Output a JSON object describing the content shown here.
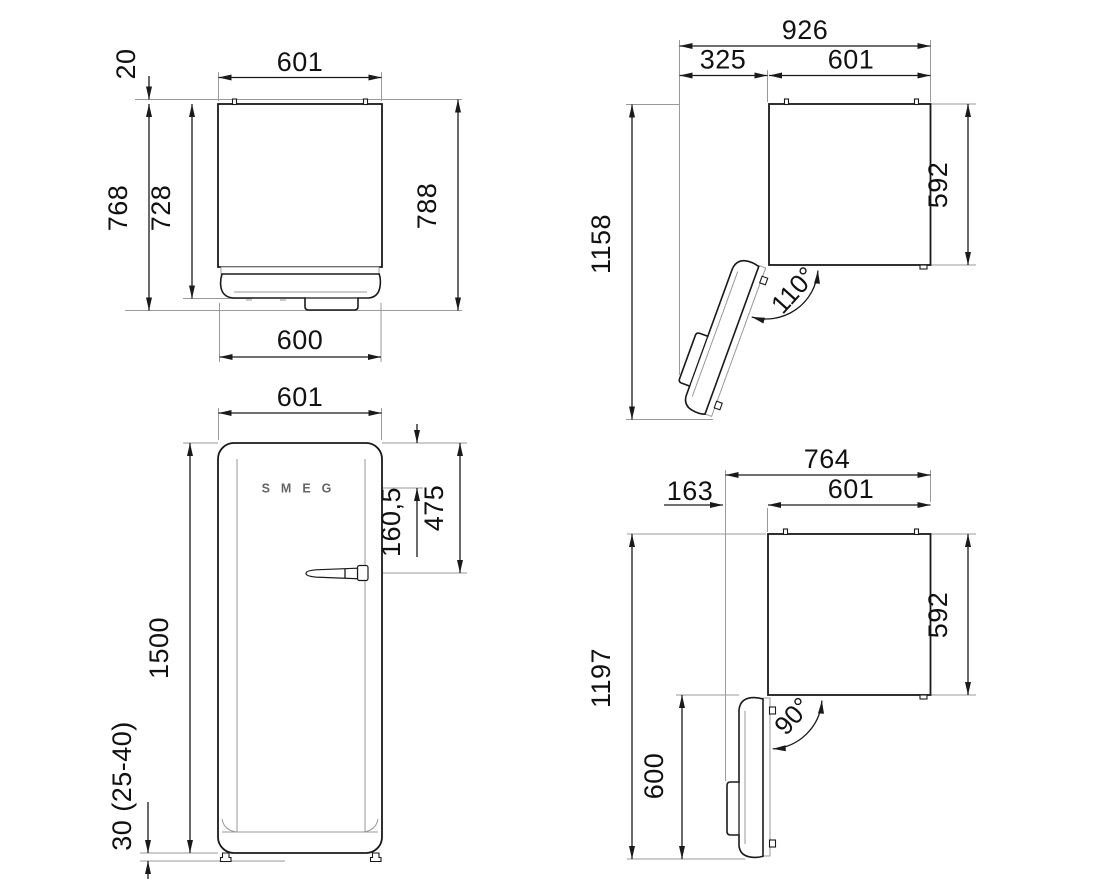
{
  "page": {
    "background": "#ffffff",
    "line_color": "#1a1a1a",
    "extension_line_color": "#9a9a9a"
  },
  "views": {
    "top_door_closed": {
      "width": "601",
      "rear_clearance": "20",
      "depth_with_door": "768",
      "cabinet_depth": "728",
      "total_depth": "788",
      "door_width": "600"
    },
    "top_door_110": {
      "overall_width": "926",
      "door_swing": "325",
      "width": "601",
      "overall_depth": "1158",
      "cabinet_depth": "592",
      "angle": "110°"
    },
    "front": {
      "width": "601",
      "handle_from_top": "475",
      "logo_from_top": "160,5",
      "height": "1500",
      "feet": "30 (25-40)",
      "brand": "SMEG"
    },
    "top_door_90": {
      "overall_width": "764",
      "door_swing": "163",
      "width": "601",
      "overall_depth": "1197",
      "cabinet_depth": "592",
      "door_depth": "600",
      "angle": "90°"
    }
  }
}
